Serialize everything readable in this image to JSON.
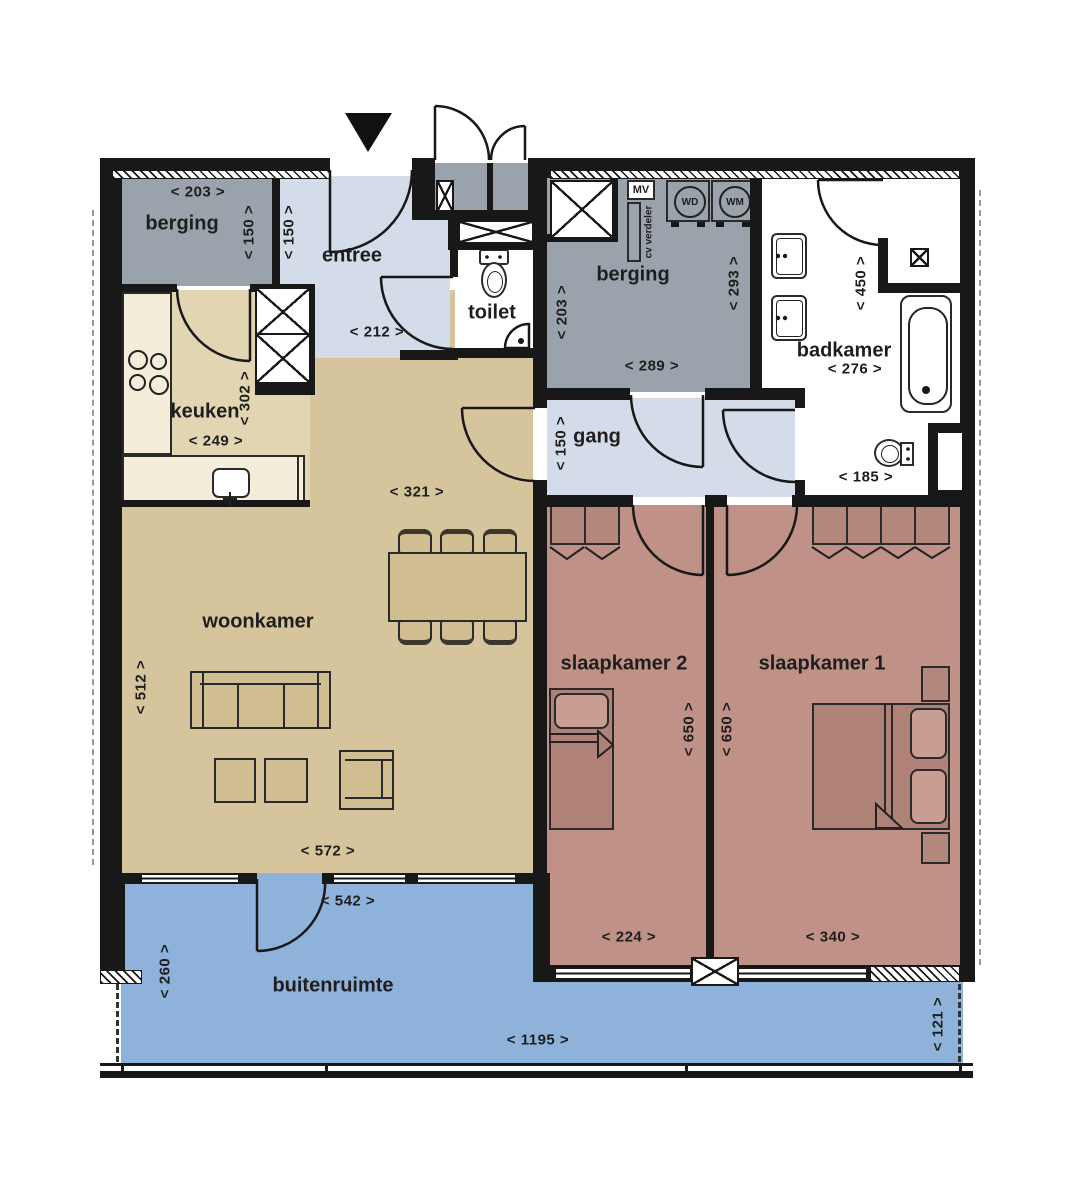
{
  "rooms": {
    "berging_links": {
      "name": "berging",
      "width": "< 203 >",
      "height": "< 150 >"
    },
    "entree": {
      "name": "entree",
      "width": "< 212 >",
      "height": "< 150 >"
    },
    "toilet": {
      "name": "toilet"
    },
    "keuken": {
      "name": "keuken",
      "width": "< 249 >",
      "height": "< 302 >"
    },
    "woonkamer": {
      "name": "woonkamer",
      "height": "< 512 >",
      "width_boven": "< 321 >",
      "width_onder": "< 572 >"
    },
    "berging_rechts": {
      "name": "berging",
      "height_links": "< 203 >",
      "height_rechts": "< 293 >",
      "width": "< 289 >"
    },
    "gang": {
      "name": "gang",
      "height": "< 150 >"
    },
    "badkamer": {
      "name": "badkamer",
      "width": "< 276 >",
      "height": "< 450 >",
      "width_onder": "< 185 >"
    },
    "slaapkamer_2": {
      "name": "slaapkamer 2",
      "height": "< 650 >",
      "width": "< 224 >"
    },
    "slaapkamer_1": {
      "name": "slaapkamer 1",
      "height": "< 650 >",
      "width": "< 340 >"
    },
    "buitenruimte": {
      "name": "buitenruimte",
      "height_links": "< 260 >",
      "deur_breedte": "< 542 >",
      "width": "< 1195 >",
      "height_rechts": "< 121 >"
    }
  },
  "installaties": {
    "mv": "MV",
    "cv_verdeler": "cv verdeler",
    "wasdroger": "WD",
    "wasmachine": "WM"
  },
  "colors": {
    "wall": "#181818",
    "berging": "#9aa3ac",
    "entree_gang": "#d3dce8",
    "woonkamer": "#d6c49c",
    "keuken": "#e2d6b2",
    "slaapkamer": "#c09186",
    "buitenruimte": "#8fb2da",
    "counter": "#f3edda"
  }
}
